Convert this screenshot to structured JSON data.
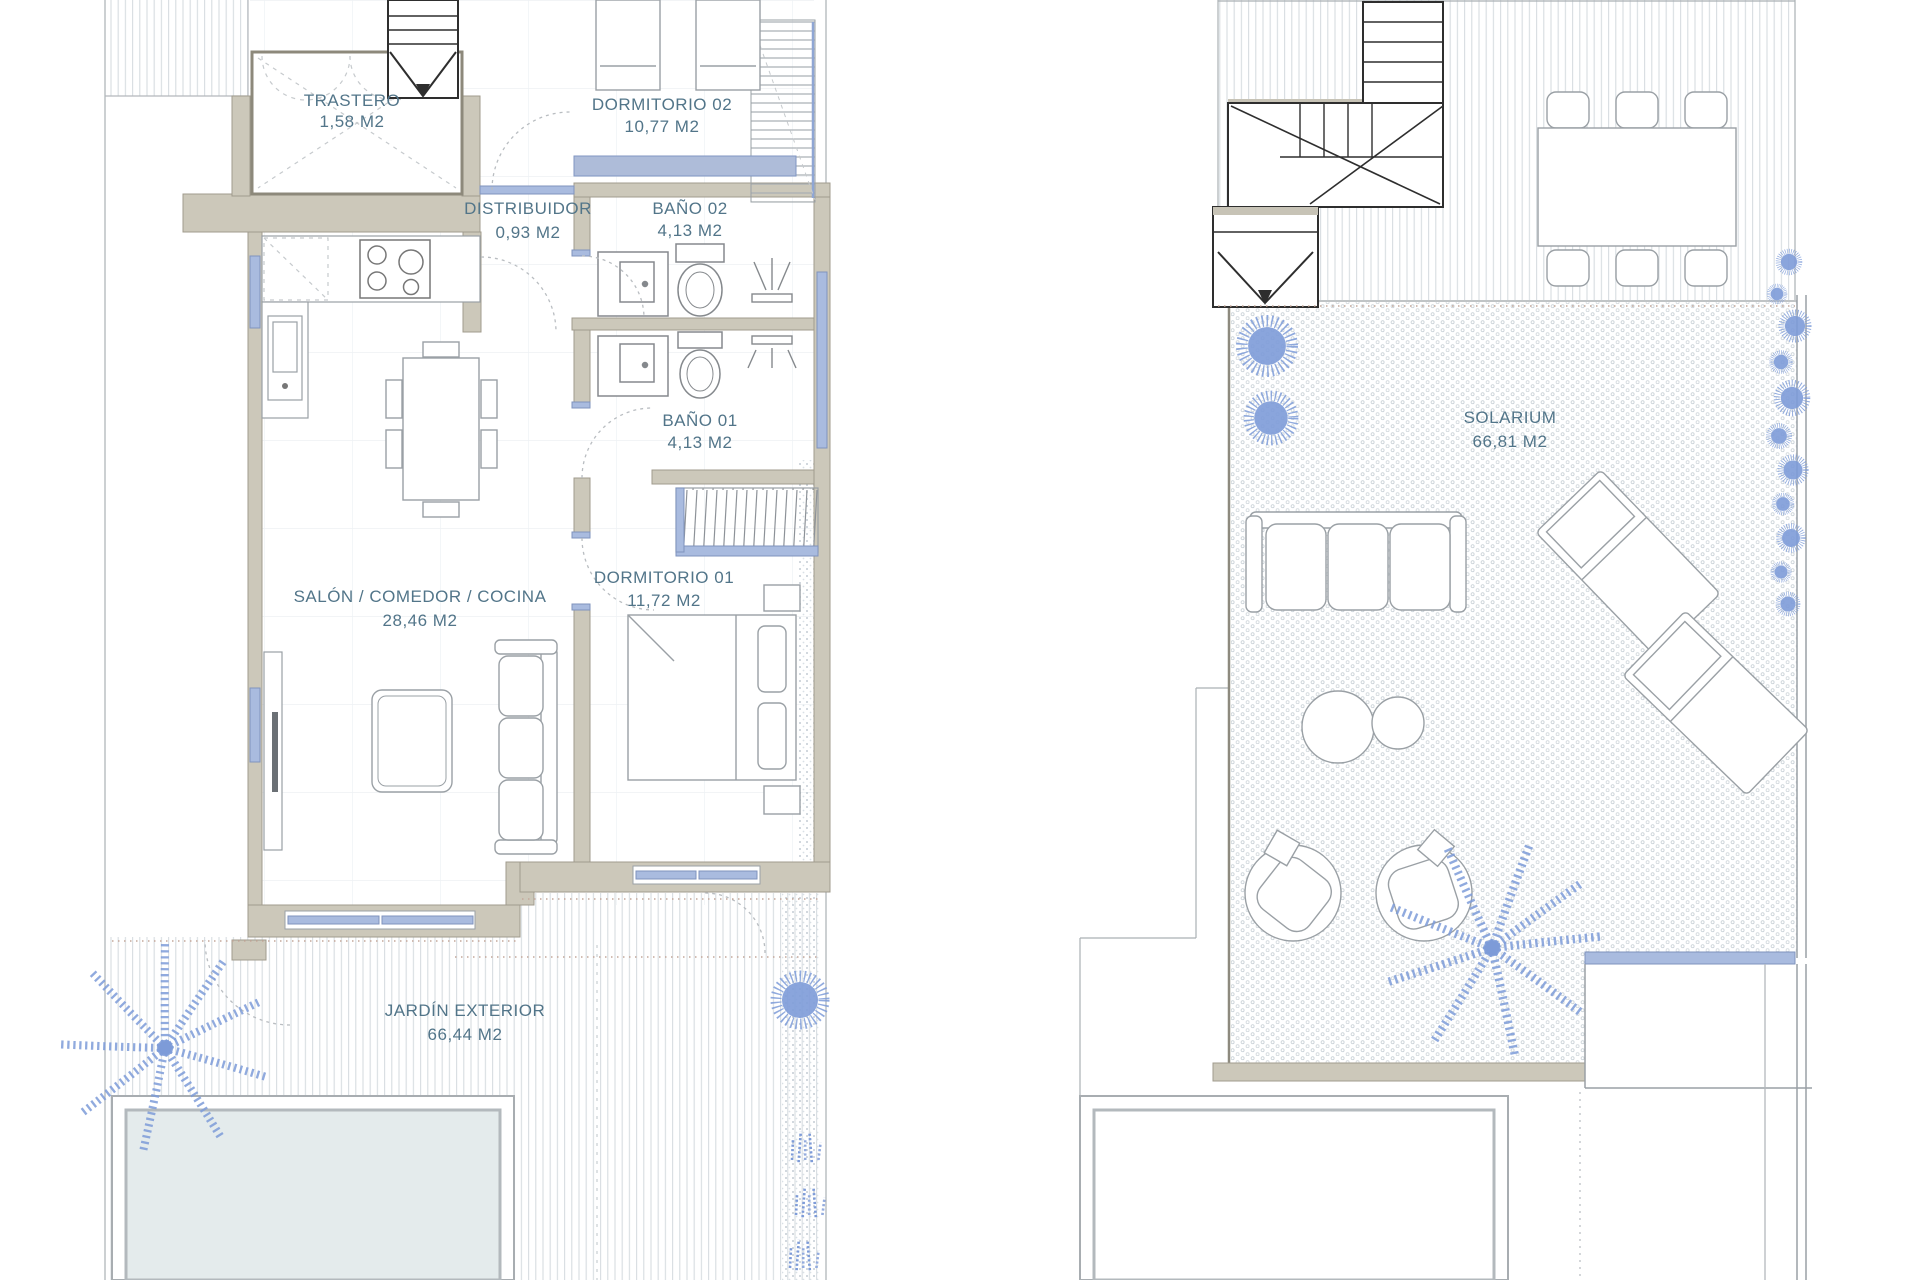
{
  "document": {
    "type": "floor-plan-drawing",
    "panels": [
      "ground-floor",
      "roof-solarium"
    ]
  },
  "palette": {
    "wall_fill": "#ccc8ba",
    "wall_stroke": "#a09b8d",
    "line_grey": "#9aa0a5",
    "stair_dark": "#2e2e2e",
    "label_text": "#527589",
    "window_blue_fill": "#a9bbdf",
    "window_blue_stroke": "#7f93bd",
    "plant_blue": "#7d9bd8",
    "pool_water": "#e4ebec",
    "boundary_dots": "#c4a79a"
  },
  "ground_floor": {
    "rooms": {
      "trastero": {
        "name": "TRASTERO",
        "area": "1,58 M2"
      },
      "dormitorio_02": {
        "name": "DORMITORIO 02",
        "area": "10,77 M2"
      },
      "distribuidor": {
        "name": "DISTRIBUIDOR",
        "area": "0,93 M2"
      },
      "bano_02": {
        "name": "BAÑO 02",
        "area": "4,13 M2"
      },
      "bano_01": {
        "name": "BAÑO 01",
        "area": "4,13 M2"
      },
      "salon_comedor_cocina": {
        "name": "SALÓN / COMEDOR / COCINA",
        "area": "28,46 M2"
      },
      "dormitorio_01": {
        "name": "DORMITORIO 01",
        "area": "11,72 M2"
      },
      "jardin_exterior": {
        "name": "JARDÍN EXTERIOR",
        "area": "66,44 M2"
      }
    }
  },
  "roof": {
    "rooms": {
      "solarium": {
        "name": "SOLARIUM",
        "area": "66,81 M2"
      }
    }
  }
}
